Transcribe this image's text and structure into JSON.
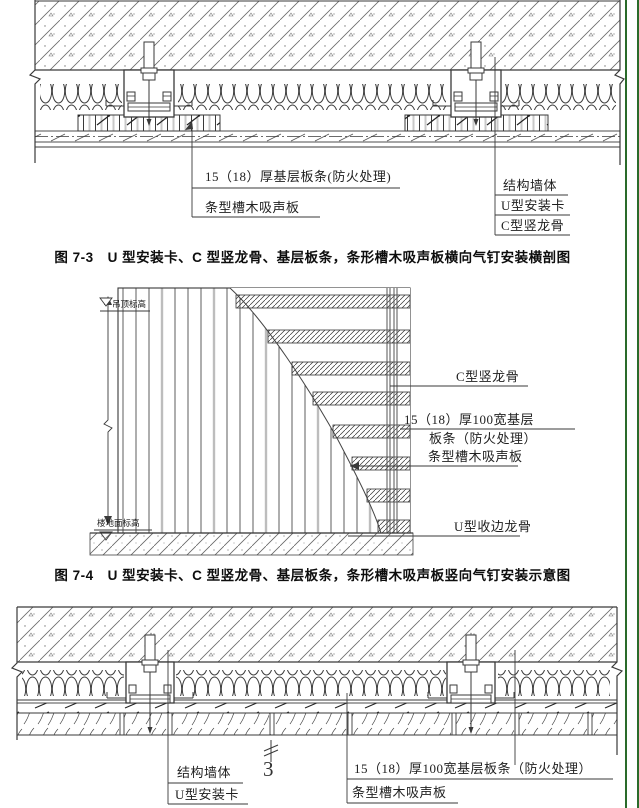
{
  "page": {
    "background": "#ffffff",
    "line_color": "#3a3a3a",
    "green_border": "#2a6b2a"
  },
  "fig1": {
    "caption": "图 7-3　U 型安装卡、C 型竖龙骨、基层板条，条形槽木吸声板横向气钉安装横剖图",
    "labels": {
      "base_strip": "15（18）厚基层板条(防火处理)",
      "acoustic_panel": "条型槽木吸声板",
      "wall": "结构墙体",
      "u_clip": "U型安装卡",
      "c_keel": "C型竖龙骨"
    }
  },
  "fig2": {
    "caption": "图 7-4　U 型安装卡、C 型竖龙骨、基层板条，条形槽木吸声板竖向气钉安装示意图",
    "labels": {
      "ceiling_level": "吊顶标高",
      "floor_level": "楼地面标高",
      "c_keel": "C型竖龙骨",
      "base_strip_line1": "15（18）厚100宽基层",
      "base_strip_line2": "板条（防火处理）",
      "acoustic_panel": "条型槽木吸声板",
      "u_edge_keel": "U型收边龙骨"
    }
  },
  "fig3": {
    "keynote": "3",
    "labels": {
      "wall": "结构墙体",
      "u_clip": "U型安装卡",
      "base_strip": "15（18）厚100宽基层板条（防火处理）",
      "acoustic_panel": "条型槽木吸声板"
    }
  }
}
